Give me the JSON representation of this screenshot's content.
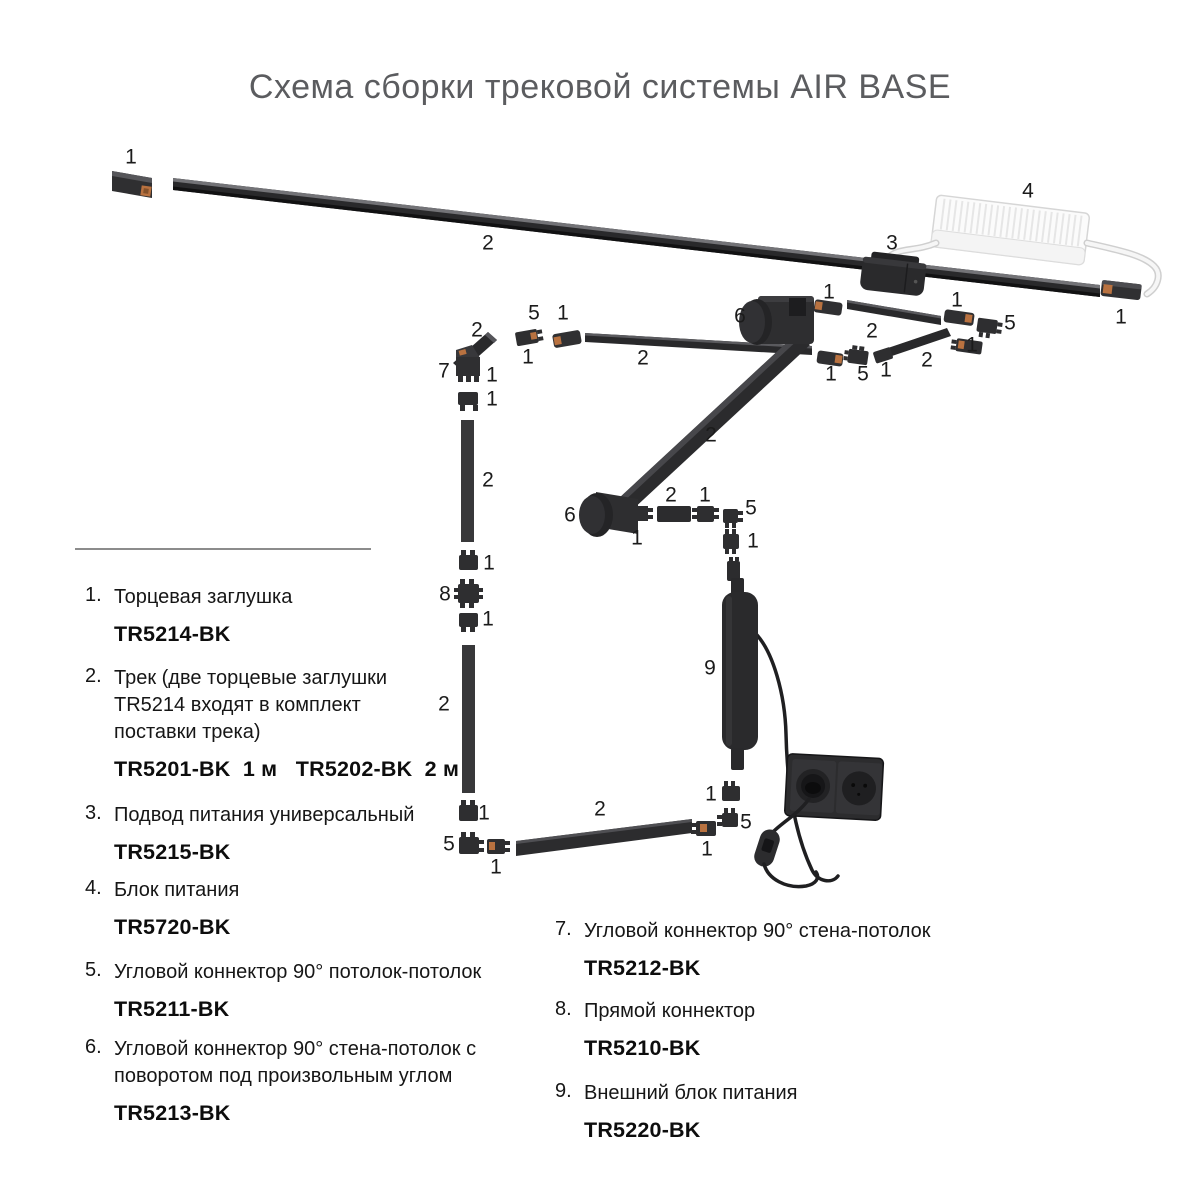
{
  "title": "Схема сборки трековой системы AIR BASE",
  "colors": {
    "track_dark": "#29292b",
    "track_highlight": "#737377",
    "connector": "#2e2e30",
    "copper_contact": "#b97240",
    "psu_white": "#fbfbfb",
    "label_text": "#1b1b1b",
    "title_text": "#5b5c5f"
  },
  "diagram": {
    "labels": [
      {
        "t": "1",
        "x": 131,
        "y": 157
      },
      {
        "t": "2",
        "x": 488,
        "y": 243
      },
      {
        "t": "3",
        "x": 892,
        "y": 243
      },
      {
        "t": "4",
        "x": 1028,
        "y": 191
      },
      {
        "t": "1",
        "x": 1121,
        "y": 317
      },
      {
        "t": "2",
        "x": 477,
        "y": 330
      },
      {
        "t": "5",
        "x": 534,
        "y": 313
      },
      {
        "t": "1",
        "x": 563,
        "y": 313
      },
      {
        "t": "1",
        "x": 528,
        "y": 357
      },
      {
        "t": "7",
        "x": 444,
        "y": 371
      },
      {
        "t": "1",
        "x": 492,
        "y": 375
      },
      {
        "t": "1",
        "x": 492,
        "y": 399
      },
      {
        "t": "6",
        "x": 740,
        "y": 316
      },
      {
        "t": "2",
        "x": 643,
        "y": 358
      },
      {
        "t": "1",
        "x": 829,
        "y": 292
      },
      {
        "t": "2",
        "x": 872,
        "y": 331
      },
      {
        "t": "1",
        "x": 957,
        "y": 300
      },
      {
        "t": "5",
        "x": 1010,
        "y": 323
      },
      {
        "t": "1",
        "x": 972,
        "y": 345
      },
      {
        "t": "2",
        "x": 927,
        "y": 360
      },
      {
        "t": "1",
        "x": 831,
        "y": 374
      },
      {
        "t": "5",
        "x": 863,
        "y": 374
      },
      {
        "t": "1",
        "x": 886,
        "y": 370
      },
      {
        "t": "2",
        "x": 711,
        "y": 435
      },
      {
        "t": "6",
        "x": 570,
        "y": 515
      },
      {
        "t": "1",
        "x": 637,
        "y": 538
      },
      {
        "t": "2",
        "x": 671,
        "y": 495
      },
      {
        "t": "1",
        "x": 705,
        "y": 495
      },
      {
        "t": "5",
        "x": 751,
        "y": 508
      },
      {
        "t": "1",
        "x": 753,
        "y": 541
      },
      {
        "t": "9",
        "x": 710,
        "y": 668
      },
      {
        "t": "2",
        "x": 488,
        "y": 480
      },
      {
        "t": "1",
        "x": 489,
        "y": 563
      },
      {
        "t": "8",
        "x": 445,
        "y": 594
      },
      {
        "t": "1",
        "x": 488,
        "y": 619
      },
      {
        "t": "2",
        "x": 444,
        "y": 704
      },
      {
        "t": "1",
        "x": 484,
        "y": 813
      },
      {
        "t": "5",
        "x": 449,
        "y": 844
      },
      {
        "t": "1",
        "x": 496,
        "y": 867
      },
      {
        "t": "2",
        "x": 600,
        "y": 809
      },
      {
        "t": "1",
        "x": 707,
        "y": 849
      },
      {
        "t": "1",
        "x": 711,
        "y": 794
      },
      {
        "t": "5",
        "x": 746,
        "y": 822
      }
    ]
  },
  "legend": {
    "left": [
      {
        "num": "1.",
        "name": "Торцевая заглушка",
        "code": "TR5214-BK"
      },
      {
        "num": "2.",
        "name": "Трек (две торцевые заглушки TR5214 входят в комплект поставки трека)",
        "code": "TR5201-BK  1 м   TR5202-BK  2 м"
      },
      {
        "num": "3.",
        "name": "Подвод питания универсальный",
        "code": "TR5215-BK"
      },
      {
        "num": "4.",
        "name": "Блок питания",
        "code": "TR5720-BK"
      },
      {
        "num": "5.",
        "name": "Угловой коннектор 90° потолок-потолок",
        "code": "TR5211-BK"
      },
      {
        "num": "6.",
        "name": "Угловой коннектор 90° стена-потолок с поворотом под произвольным углом",
        "code": "TR5213-BK"
      }
    ],
    "right": [
      {
        "num": "7.",
        "name": "Угловой коннектор 90° стена-потолок",
        "code": "TR5212-BK"
      },
      {
        "num": "8.",
        "name": "Прямой коннектор",
        "code": "TR5210-BK"
      },
      {
        "num": "9.",
        "name": "Внешний блок питания",
        "code": "TR5220-BK"
      }
    ]
  }
}
